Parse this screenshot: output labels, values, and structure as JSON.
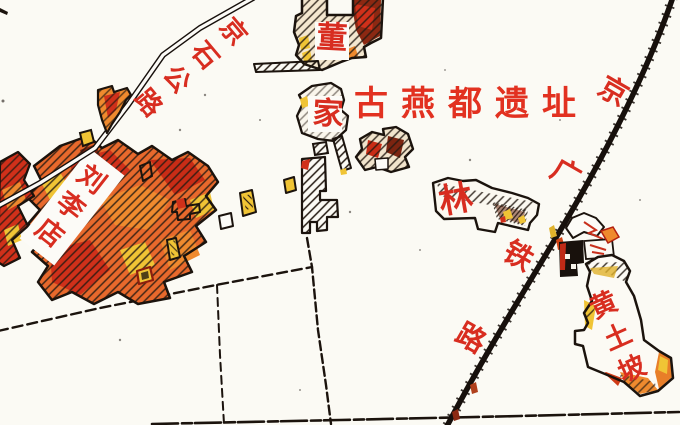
{
  "map_title": {
    "text": "古燕都遗址",
    "color": "#e23120"
  },
  "labels": {
    "jingshi_road": "京石公路",
    "dongjia": "董家",
    "liulidian": "刘李店",
    "lin": "林",
    "jingguang_railway": "京广铁路",
    "huangtupo": "黄土坡"
  },
  "colors": {
    "label_red": "#d82d20",
    "map_ink": "#1b130d",
    "village_red": "#d0301a",
    "village_orange": "#e87e28",
    "village_yellow": "#f0c435",
    "village_maroon": "#7c2410",
    "background": "#fbfaf4"
  }
}
